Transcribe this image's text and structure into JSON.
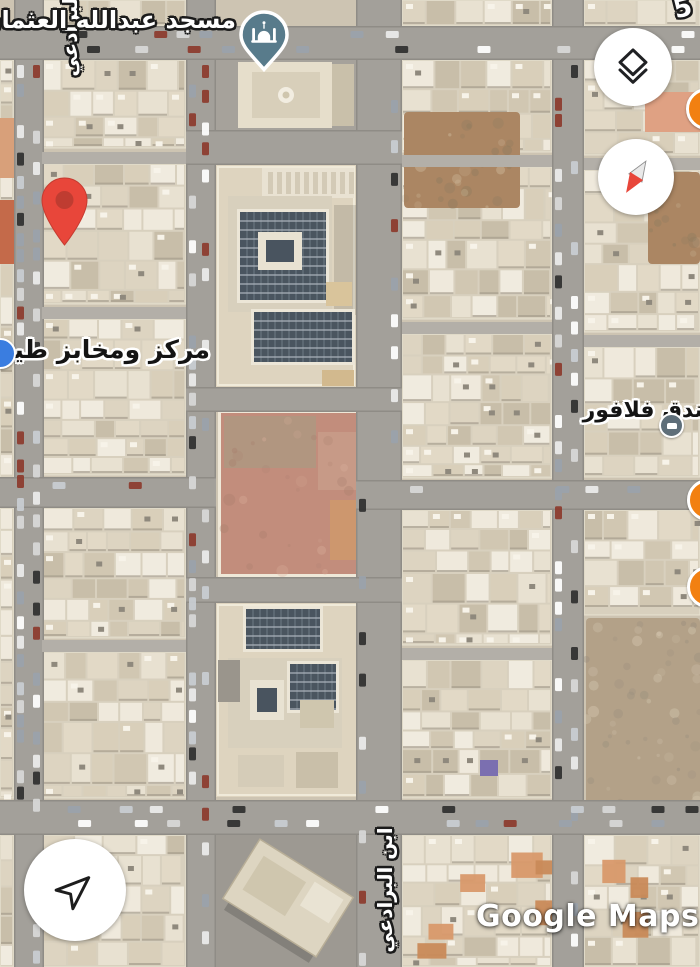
{
  "app_name": "Google Maps",
  "watermark": "Google Maps",
  "labels": {
    "mosque": "مسجد عبدالله العثمان",
    "bakery": "مركز ومخابز طيبه",
    "hotel": "فندق فلافور",
    "street": "ابن البرادعي",
    "street_fragment_top_right": "م 5"
  },
  "icons": {
    "mosque_pin": "mosque-icon",
    "destination": "red-pin-icon",
    "layers": "layers-icon",
    "compass": "compass-icon",
    "my_location": "navigation-arrow-icon",
    "hotel_poi": "bed-icon"
  },
  "colors": {
    "pin_red": "#e8463a",
    "pin_red_inner": "#bf3c31",
    "mosque_pin": "#587b8b",
    "poi_orange": "#f28011",
    "poi_blue": "#3a7de0",
    "poi_dark": "#5e6e79",
    "compass_red": "#e8463a",
    "road": "#a3a09a",
    "road_edge": "#8f8c86",
    "alley": "#b3afa8",
    "ground": "#cdc4b2",
    "block_base": "#d8d0be",
    "pink_lot": "#c28d7c",
    "solar_panel": "#4a555f",
    "dirt": "#ab8663",
    "dirt_rocky": "#b3a188",
    "asphalt": "#a6a29b"
  }
}
